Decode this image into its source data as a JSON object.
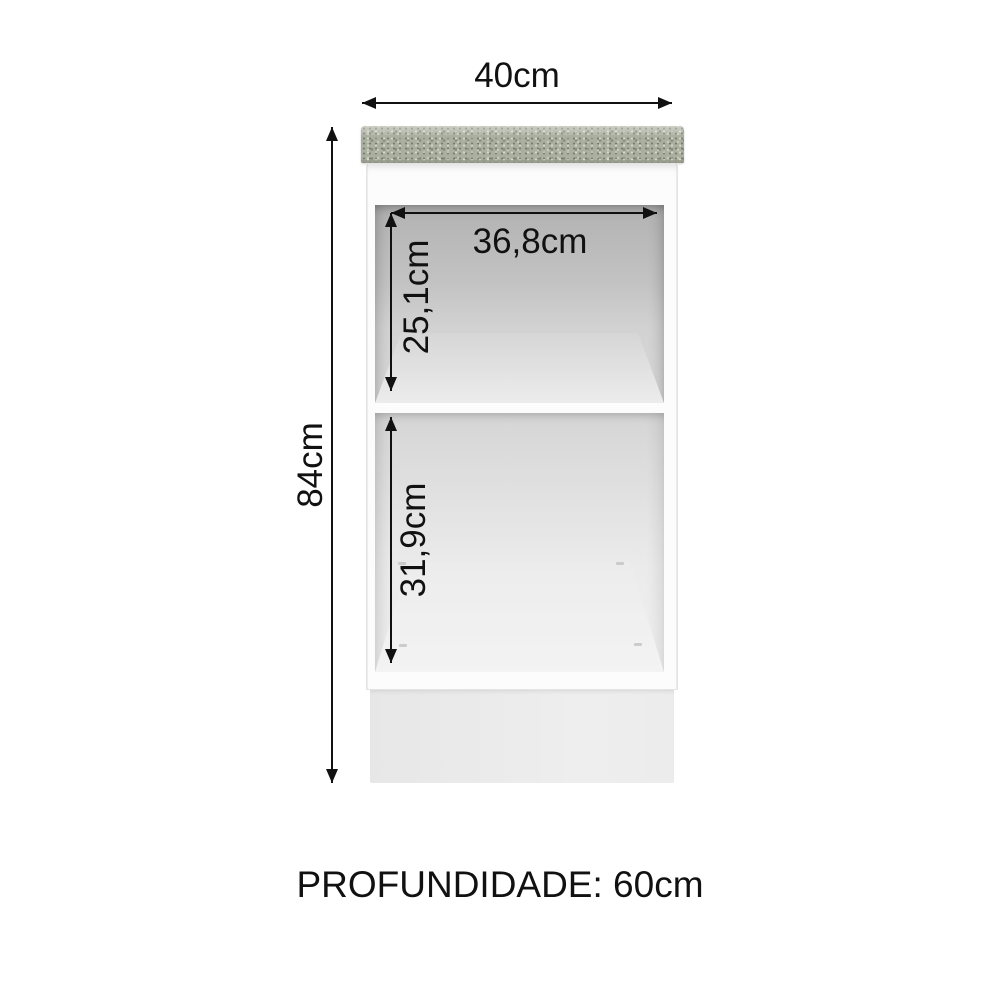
{
  "diagram": {
    "title": "cabinet-dimension-diagram",
    "dimensions": {
      "width": {
        "label": "40cm"
      },
      "height": {
        "label": "84cm"
      },
      "inner_width": {
        "label": "36,8cm"
      },
      "top_compartment_height": {
        "label": "25,1cm"
      },
      "bottom_compartment_height": {
        "label": "31,9cm"
      },
      "depth": {
        "label": "PROFUNDIDADE: 60cm"
      }
    },
    "colors": {
      "annotation": "#111111",
      "countertop_base": "#abaf9f",
      "cabinet_white": "#fcfcfc",
      "cabinet_edge": "#e4e4e4",
      "base_panel": "#ebebeb",
      "background": "#ffffff"
    }
  }
}
